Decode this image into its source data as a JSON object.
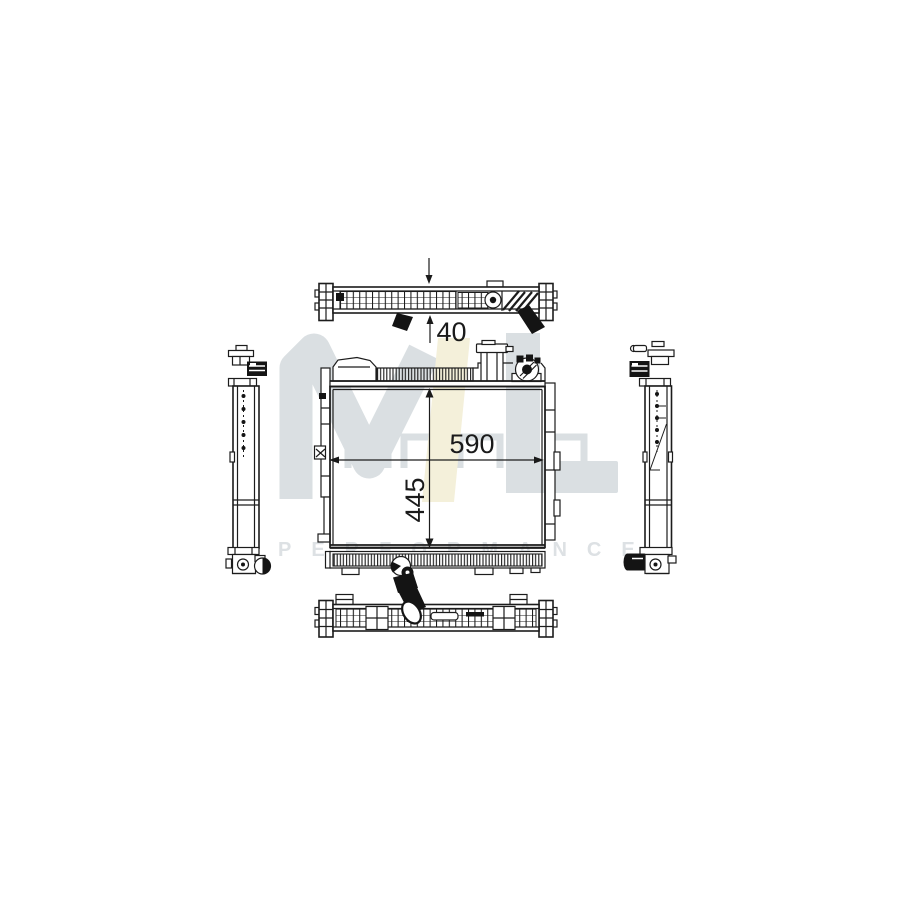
{
  "figure": {
    "background_color": "#ffffff",
    "line_color": "#1c1c1c",
    "description_text": ""
  },
  "dimensions": {
    "depth": {
      "value": "40"
    },
    "width": {
      "value": "590"
    },
    "height": {
      "value": "445"
    }
  },
  "watermark": {
    "monogram": "ML",
    "subtitle": "PERFORMANCE",
    "monogram_gray": "#dadfe2",
    "monogram_yellow": "#f4f0da",
    "subtitle_color": "#dde1e4"
  }
}
